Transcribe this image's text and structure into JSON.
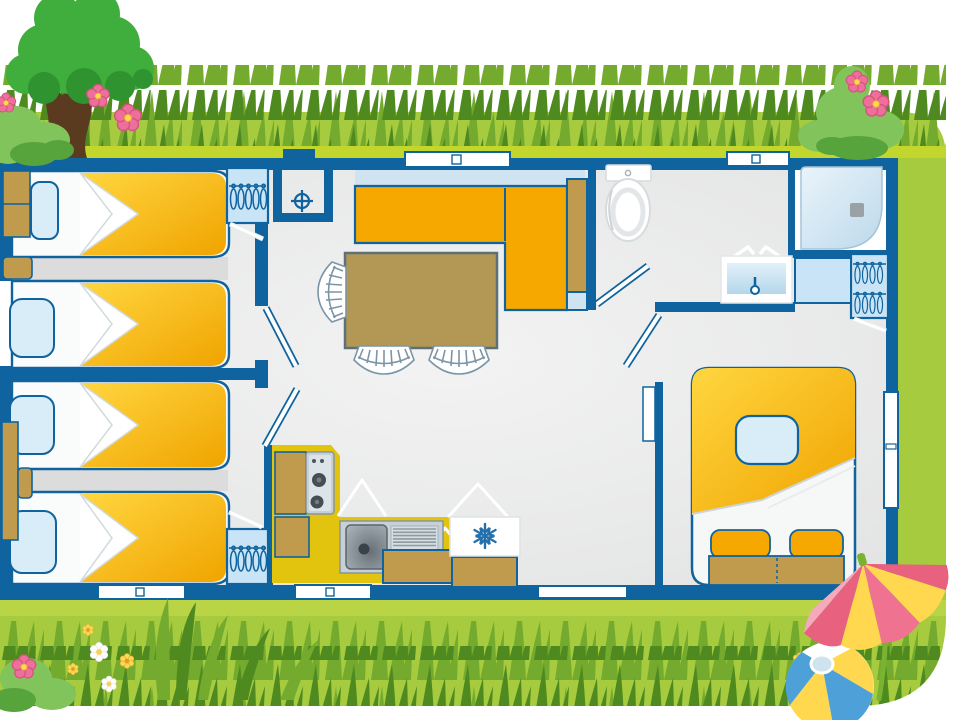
{
  "scene": {
    "kind": "illustrated mobile-home floor plan with garden decor",
    "style": "flat cartoon vector, top-down view",
    "visible_text": "none"
  },
  "colors": {
    "wall_blue": "#0f639e",
    "floor_grey_light": "#f3f3f3",
    "floor_grey": "#e6e7e7",
    "floor_shadow_grey": "#dcdcdc",
    "glass_light_blue": "#cfe3f1",
    "cabinet_light_blue": "#c8e4f6",
    "pillow_light_blue": "#d9edf9",
    "bed_yellow_light": "#ffd640",
    "bed_yellow_deep": "#f0a400",
    "sofa_orange": "#f7a800",
    "counter_yellow": "#e2c30d",
    "furniture_tan": "#c09b4d",
    "table_tan": "#b39754",
    "appliance_grey": "#c6d0d6",
    "appliance_dark_grey": "#454e54",
    "snowflake_blue": "#2470ad",
    "grass_base_green": "#a6cb3e",
    "grass_mid_green": "#74ab2e",
    "grass_dark_green": "#4e8a1f",
    "mow_strip_green": "#c3d62e",
    "bottom_strip_green": "#b9d546",
    "tree_green": "#3fae3c",
    "tree_dark_green": "#2f9330",
    "trunk_brown": "#5b3b20",
    "bush_light_green": "#82c45c",
    "bush_dark_green": "#57a33c",
    "flower_pink": "#ee6f9c",
    "flower_pink_deep": "#d4567f",
    "flower_yellow": "#ffd84f",
    "umbrella_pink": "#ef7291",
    "umbrella_pink_deep": "#e8617f",
    "umbrella_yellow": "#ffd84f",
    "umbrella_stem_green": "#7ab332",
    "ball_blue": "#4da0d8",
    "ball_yellow": "#ffd84f",
    "ball_cap_blue": "#cfe3ef"
  },
  "floorplan": {
    "rooms": [
      "twin-bedroom-top-left",
      "twin-bedroom-bottom-left",
      "living-dining-area",
      "kitchen",
      "bathroom-wc",
      "shower-room",
      "double-bedroom-right",
      "technical-closet"
    ],
    "furniture_counts": {
      "single_beds": 4,
      "double_beds": 1,
      "dining_chairs": 3,
      "dining_tables": 1,
      "wardrobes_with_hangers": 3,
      "sofa_sections": 2,
      "bedside_units": 2
    },
    "fixtures": [
      "toilet",
      "washbasin",
      "shower-tray",
      "kitchen-sink",
      "gas-hob",
      "fridge"
    ],
    "openings": {
      "windows": 7,
      "swing_door_leaves": 5,
      "small_cabinet_door_leaves": 3
    }
  },
  "decor": {
    "items": [
      "tree",
      "flower-bush-top-left",
      "flower-bush-top-right",
      "grass-band-top",
      "grass-band-bottom",
      "tall-grass-tuft-bottom-left",
      "daisies",
      "beach-umbrella",
      "beach-ball"
    ]
  }
}
